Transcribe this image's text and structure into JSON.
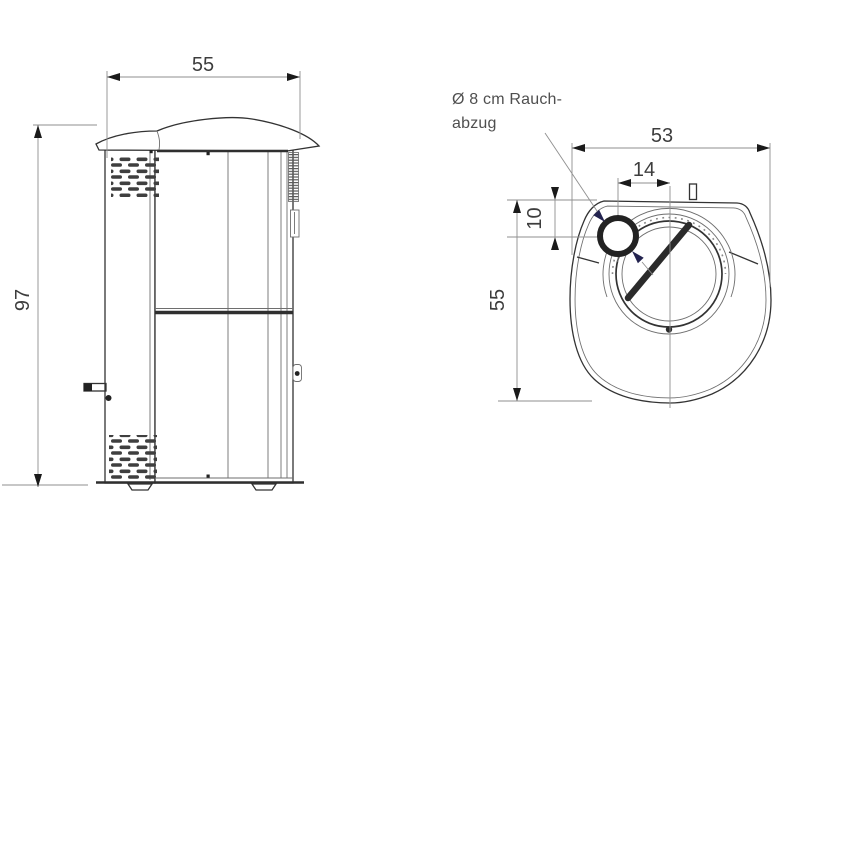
{
  "colors": {
    "background": "#ffffff",
    "line": "#333333",
    "line_light": "#6e6e6e",
    "dim_line": "#8f8f8f",
    "arrow": "#1a1a1a",
    "vent_arrow": "#23234f",
    "dim_text": "#3d3d3d",
    "note_text": "#4f4f4f",
    "vent_slot": "#3f3f3f"
  },
  "side_view": {
    "width_label": "55",
    "height_label": "97"
  },
  "top_view": {
    "width_label": "53",
    "vent_offset_label": "14",
    "vent_depth_label": "10",
    "depth_label": "55",
    "vent_note_line1": "Ø 8 cm Rauch-",
    "vent_note_line2": "abzug"
  }
}
